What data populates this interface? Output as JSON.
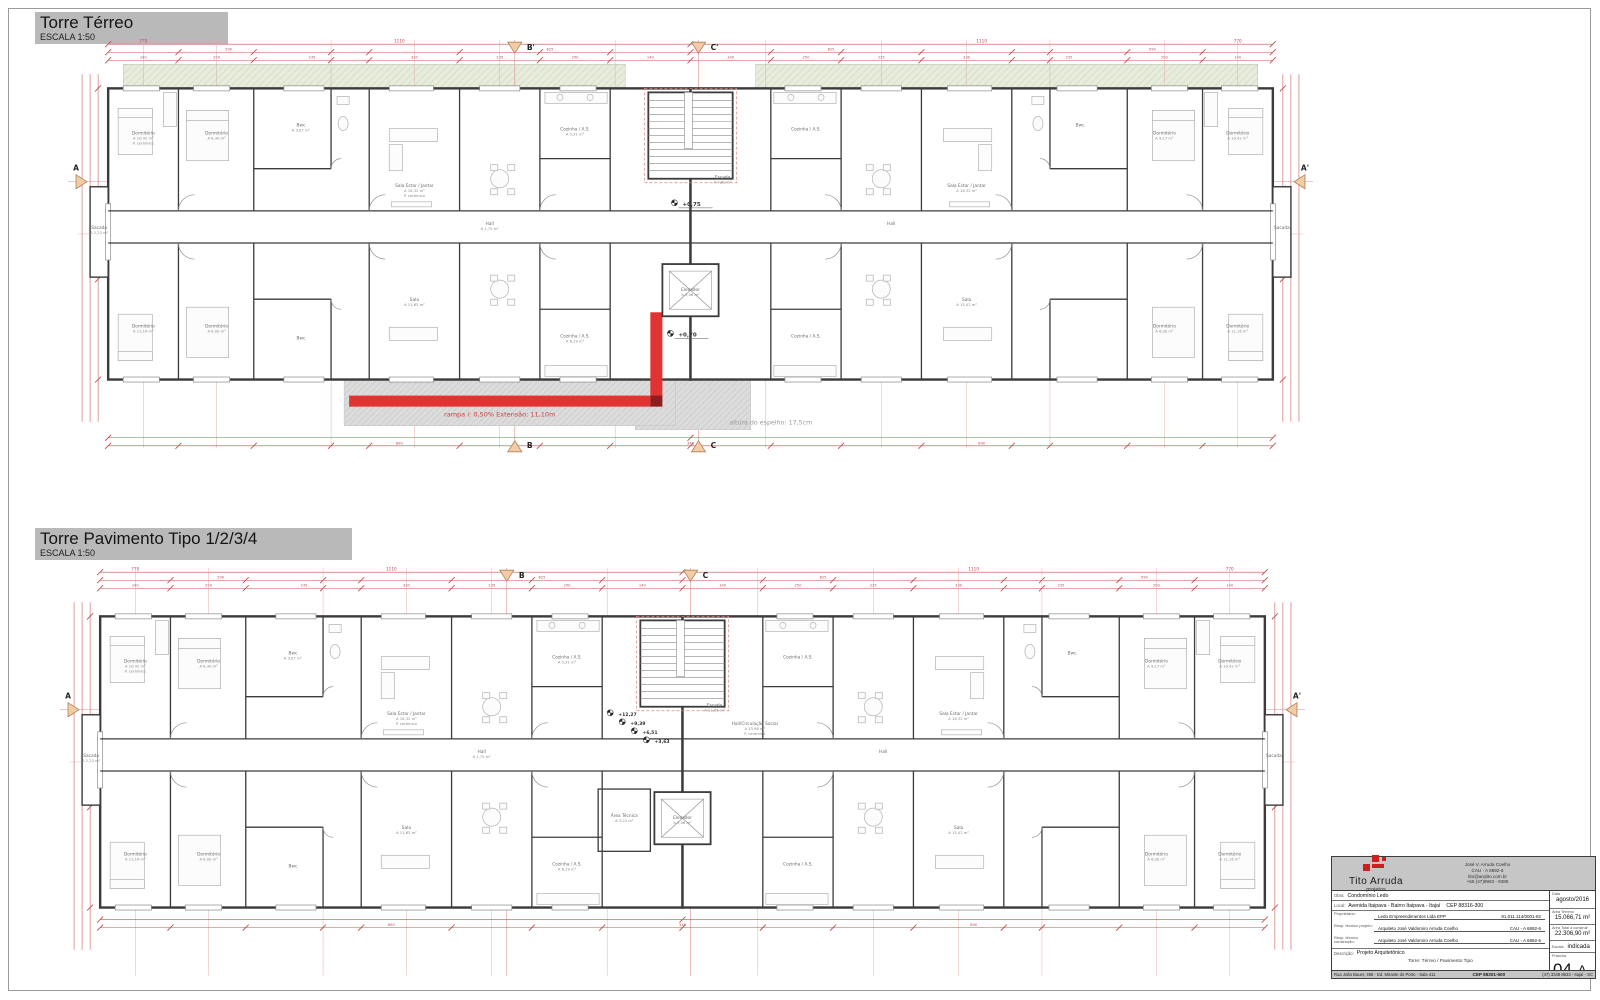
{
  "sheet": {
    "plan1": {
      "title": "Torre Térreo",
      "scale": "ESCALA 1:50"
    },
    "plan2": {
      "title": "Torre Pavimento Tipo 1/2/3/4",
      "scale": "ESCALA 1:50"
    }
  },
  "rooms": {
    "dormitorio": "Dormitório",
    "sala_estar": "Sala Estar / Jantar",
    "sala": "Sala",
    "cozinha_as": "Cozinha / A.S.",
    "bwc": "Bwc",
    "hall": "Hall",
    "sacada": "Sacada",
    "escada": "Escada",
    "elevador": "Elevador",
    "area_tecnica": "Área Técnica",
    "hall_circ": "Hall/Circulação Social",
    "finish": "P. cerâmico"
  },
  "areas": {
    "dorm_a": "A 10,42 m²",
    "dorm_b": "A 8,30 m²",
    "dorm_c": "A 11,16 m²",
    "dorm_d": "A 8,00 m²",
    "dorm_e": "A 9,17 m²",
    "sala_estar": "A 16,32 m²",
    "sala": "A 13,62 m²",
    "sala2": "A 15,42 m²",
    "cozinha": "A 5,31 m²",
    "cozinha2": "A 6,19 m²",
    "bwc": "A 3,07 m²",
    "bwc2": "A 3,21 m²",
    "hall": "A 1,75 m²",
    "sacada": "A 2,22 m²",
    "escada_terreo": "A 7,60 m²",
    "escada_tipo": "A 11,95 m²",
    "elevador": "A 3,96 m²",
    "area_tecnica": "A 3,22 m²",
    "hall_circ": "A 13,98 m²"
  },
  "annotations": {
    "terreo": {
      "level_hall": "+0,75",
      "level_plaza": "+0,70",
      "ramp_note": "rampa i: 0,50% Extensão: 11,10m",
      "espelho_note": "altura do espelho: 17,5cm"
    },
    "tipo": {
      "l1": "+12,27",
      "l2": "+9,39",
      "l3": "+6,51",
      "l4": "+3,63"
    }
  },
  "sections": {
    "a": "A",
    "a_p": "A'",
    "b": "B",
    "b_p": "B'",
    "c": "C",
    "c_p": "C'"
  },
  "dims": {
    "n140": "140",
    "n250": "250",
    "n235": "235",
    "n330": "330",
    "n590": "590",
    "n625": "625",
    "n770": "770",
    "n1110": "1110",
    "n890": "890",
    "n348": "348"
  },
  "titleblock": {
    "logo_title": "Tito Arruda",
    "logo_sub": "projetos",
    "contact_line1": "José V. Arruda Coelho",
    "contact_line2": "CAU - A 6892-6",
    "contact_line3": "tito@arqtito.com.br",
    "contact_line4": "+55 (47)9983 - 9385",
    "obra_label": "Obra:",
    "obra": "Condomínio Ledo",
    "local_label": "Local:",
    "local": "Avenida Itaipava - Bairro Itaipava - Itajaí",
    "local_cep": "CEP 88316-300",
    "data_label": "Data",
    "data": "agosto/2016",
    "proprietario_label": "Proprietário:",
    "proprietario": "Ledo Empreendimentos Ltda EPP",
    "proprietario_doc": "81.011.114/0001-82",
    "resp_projeto_label": "Resp. técnico projeto:",
    "resp_projeto": "Arquiteto José Valdomiro Arruda Coelho",
    "resp_projeto_reg": "CAU - A 6892-6",
    "resp_construcao_label": "Resp. técnico construção:",
    "resp_construcao": "Arquiteto José Valdomiro Arruda Coelho",
    "resp_construcao_reg": "CAU - A 6892-6",
    "area_terreno_label": "Área Terreno",
    "area_terreno": "15.066,71 m²",
    "area_total_label": "Área Total a construir",
    "area_total": "22.306,90 m²",
    "escala_label": "Escala:",
    "escala": "indicada",
    "descricao_label": "Descrição:",
    "descricao": "Projeto Arquitetônico",
    "conteudo": "Torre: Térreo / Pavimento Tipo",
    "prancha_label": "Prancha",
    "prancha_num": "04",
    "prancha_de": "de",
    "prancha_serie": "A",
    "footer_address": "Rua João Bauer, 466 - Ed. Mirante do Porto - Sala 411",
    "footer_cep": "CEP 88301-500",
    "footer_phone": "(47) 3348 8633 - Itajaí - SC"
  }
}
